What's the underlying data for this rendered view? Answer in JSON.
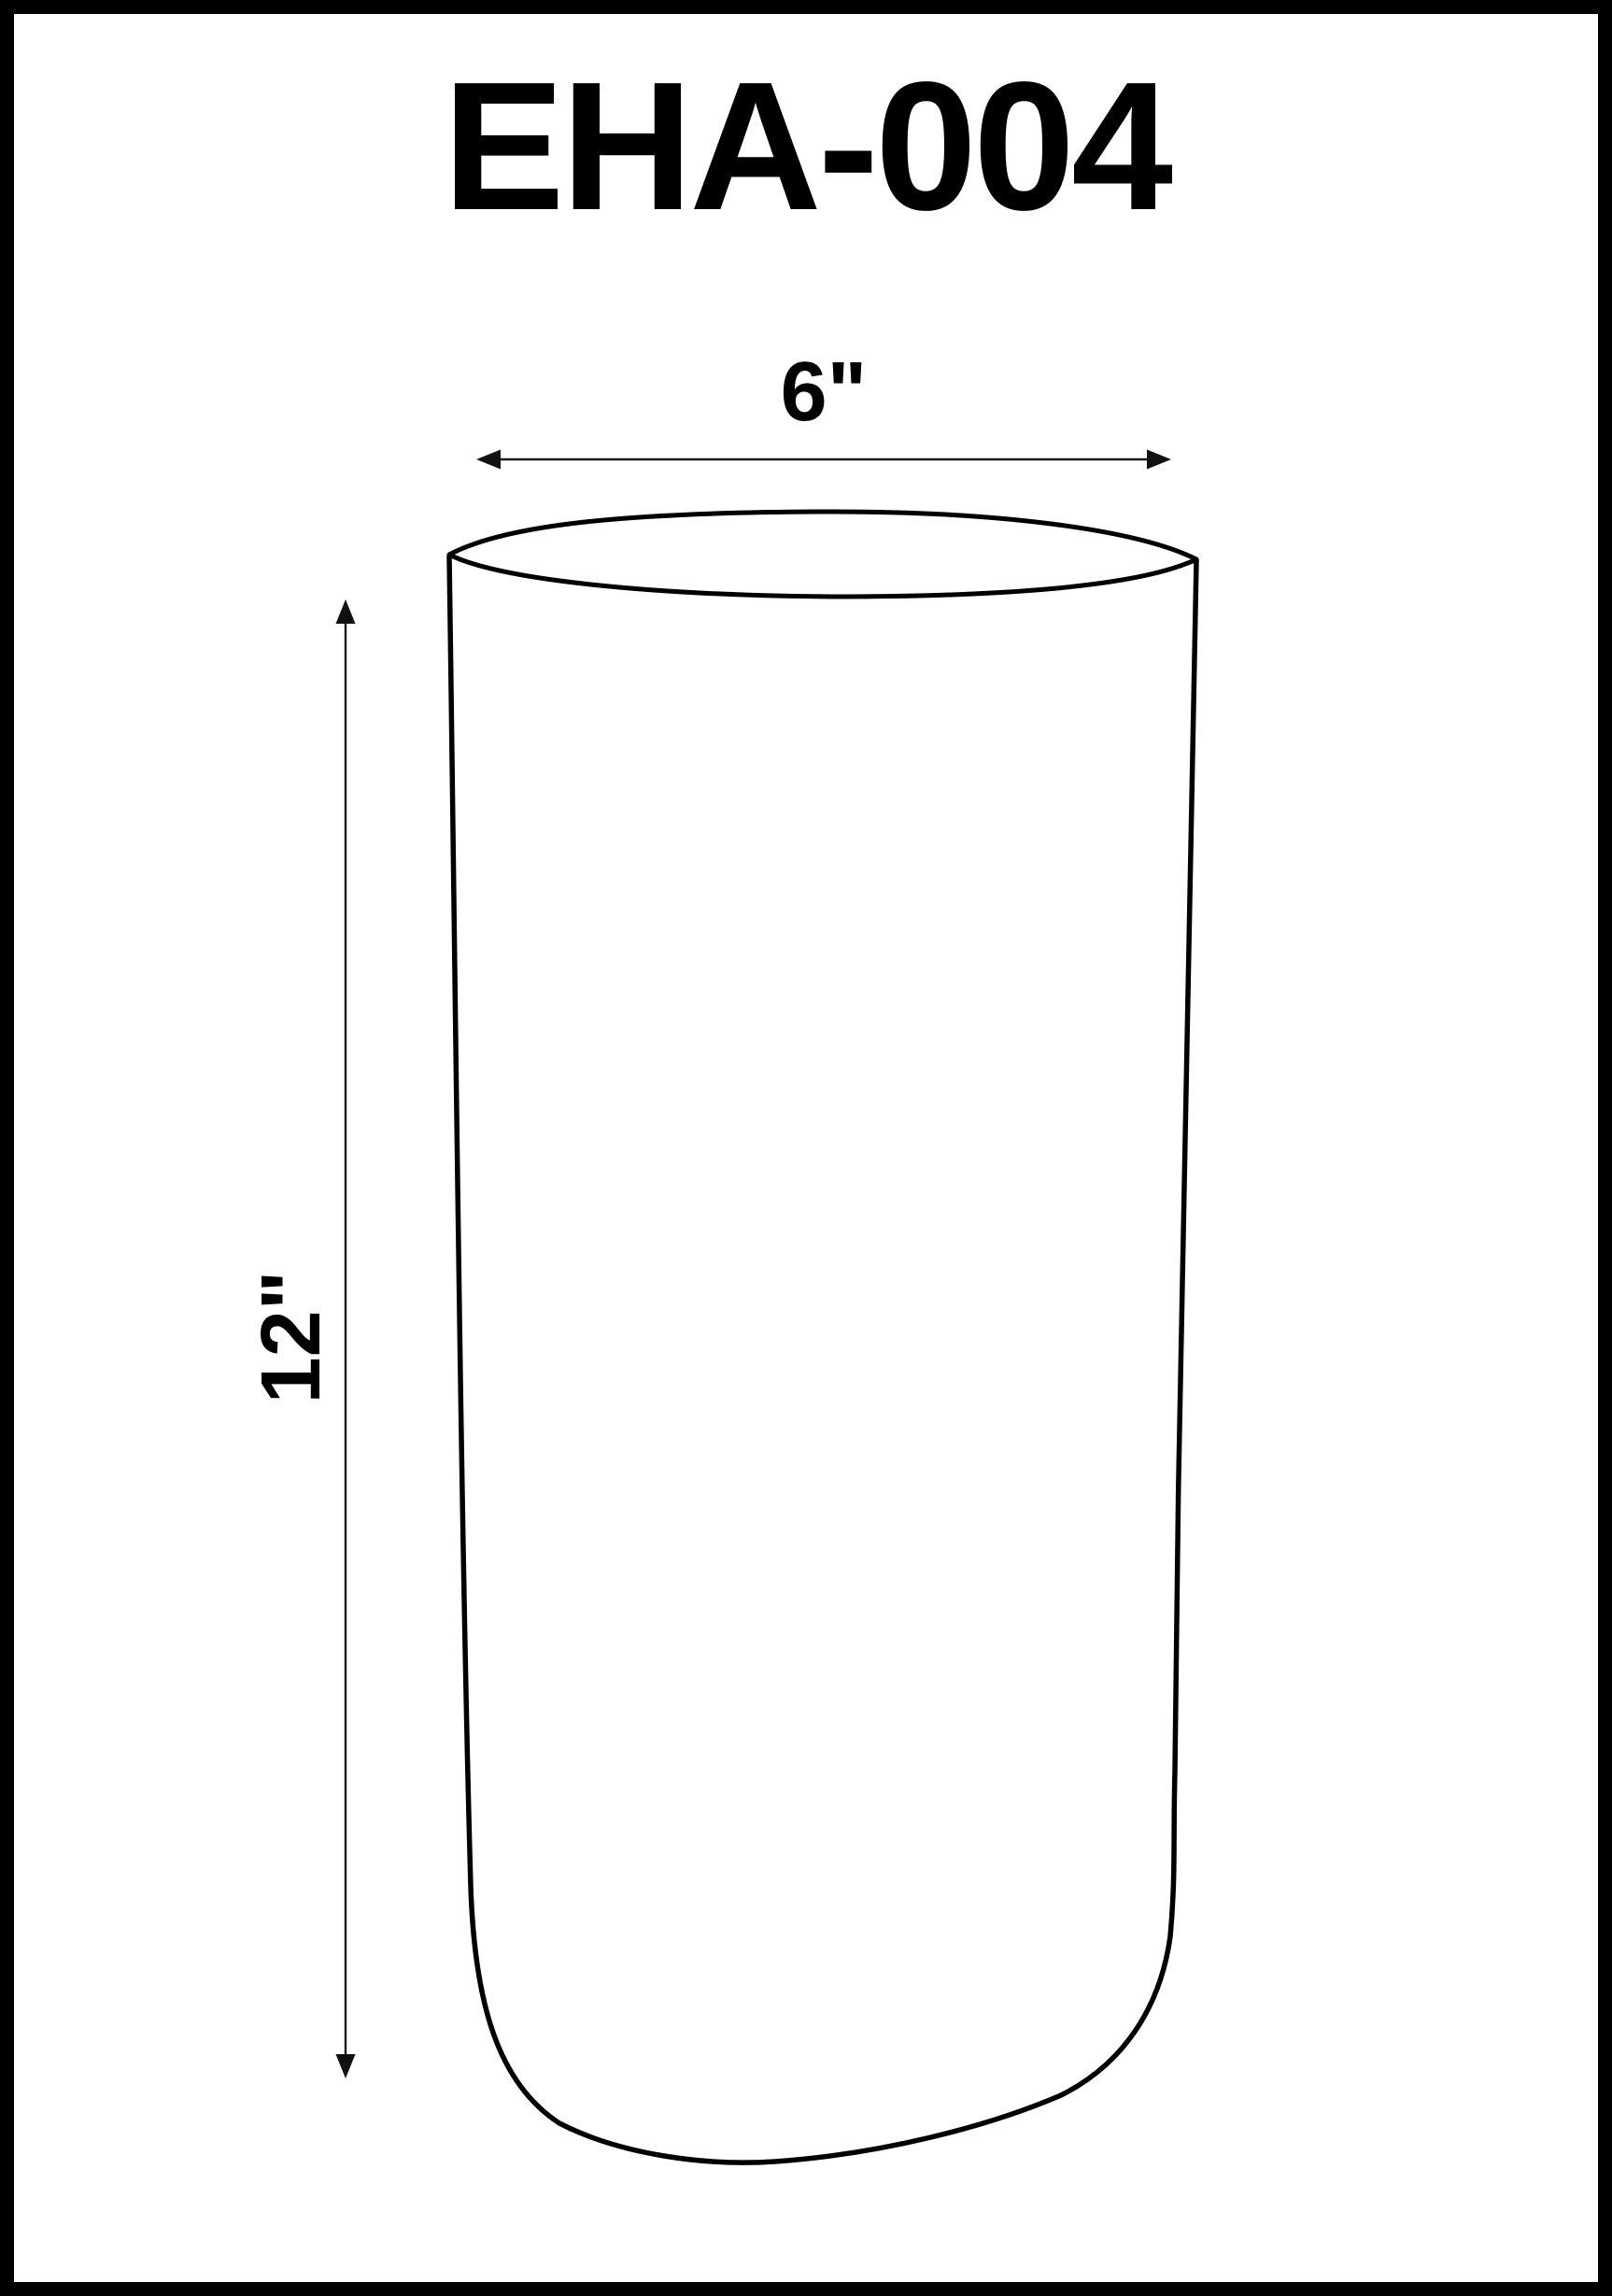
{
  "sheet": {
    "title": "EHA-004",
    "background_color": "#ffffff",
    "border_color": "#000000"
  },
  "drawing": {
    "shape": "cylinder",
    "line_color": "#000000",
    "dimension_line_color": "#1a1a1a",
    "dimensions": {
      "width": {
        "label": "6\""
      },
      "height": {
        "label": "12\""
      }
    },
    "icons": {
      "width_arrowheads": [
        "arrowhead-left-icon",
        "arrowhead-right-icon"
      ],
      "height_arrowheads": [
        "arrowhead-up-icon",
        "arrowhead-down-icon"
      ]
    }
  }
}
